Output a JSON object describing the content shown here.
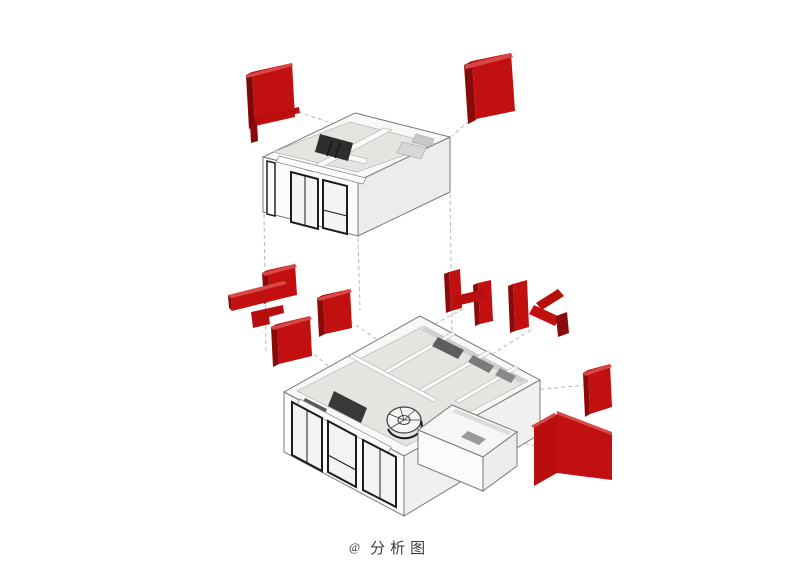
{
  "caption": {
    "marker": "@",
    "text": "分析图"
  },
  "palette": {
    "background": "#ffffff",
    "red_face": "#c21010",
    "red_mid": "#b90e0e",
    "red_dark": "#8a0909",
    "red_deep": "#7d0808",
    "red_light": "#d84848",
    "wall_white": "#fcfcfb",
    "wall_shade": "#ececea",
    "floor_grey": "#e4e4e1",
    "detail_dark": "#2e2e2e",
    "edge_grey": "#8a8a8a",
    "dash_grey": "#b8b8b8"
  },
  "elements": {
    "upper_floor": [
      "red-wall-panel-left",
      "red-wall-panel-right"
    ],
    "lower_floor": [
      "red-furniture-cluster",
      "red-partition-panel",
      "red-frame-h",
      "red-frame-k",
      "red-wall-panel-east",
      "red-corner-walls"
    ]
  }
}
